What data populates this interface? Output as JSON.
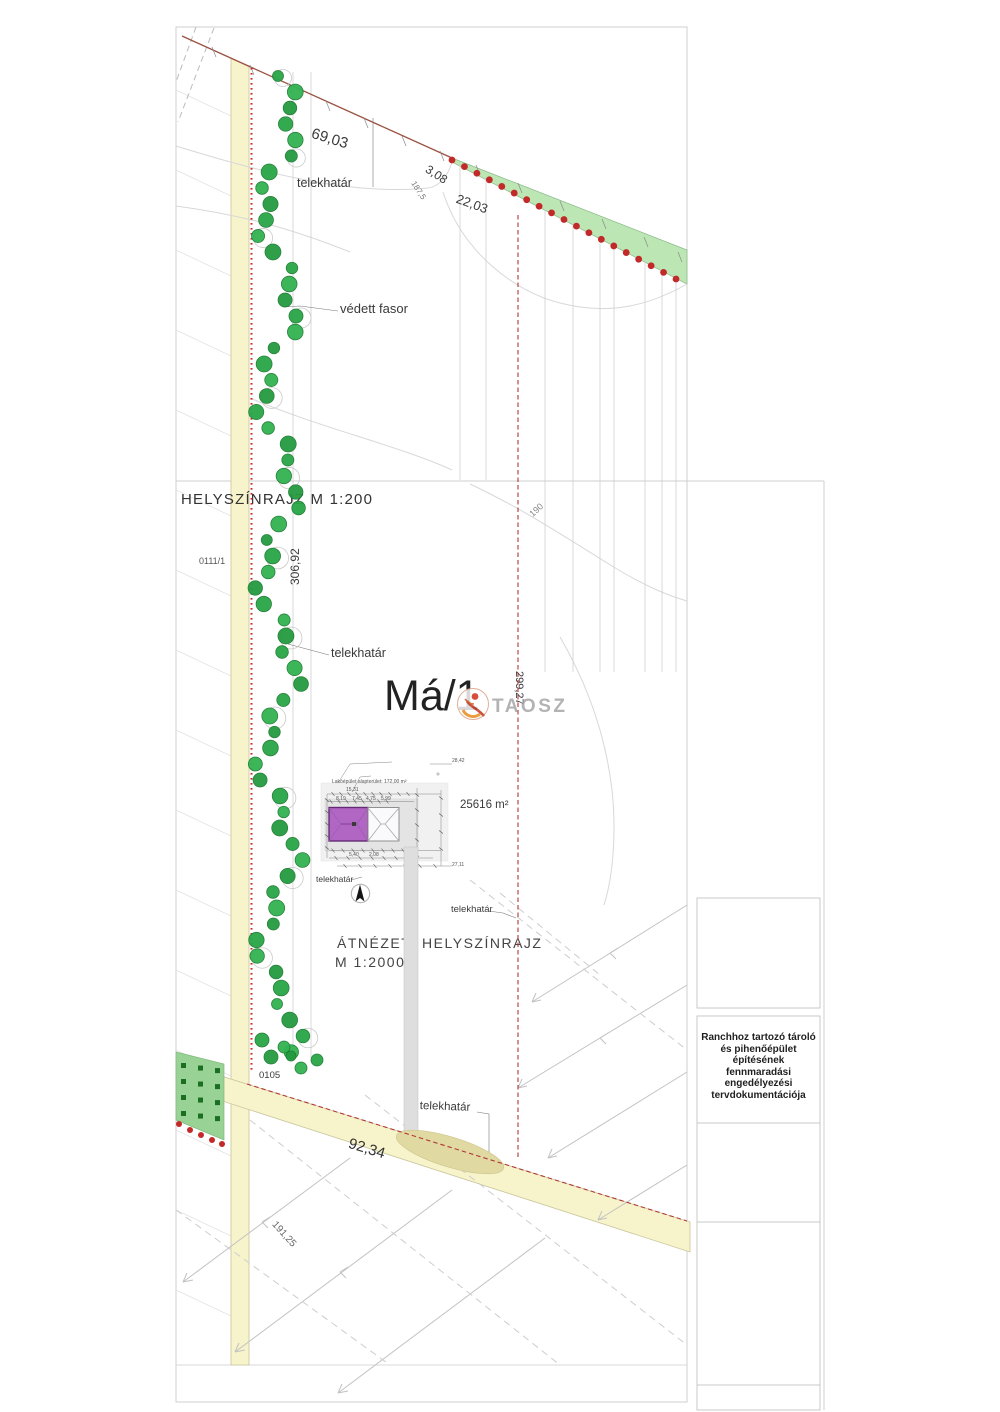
{
  "document": {
    "watermark_text": "TAOSZ"
  },
  "plan_200": {
    "title": "HELYSZÍNRAJZ M 1:200",
    "zone_label": "Má/1",
    "parcel_area": "25616 m²",
    "neighbor_parcel": "0111/1",
    "boundary_label": "telekhatár",
    "protected_trees_label": "védett fasor",
    "contour_label": "190",
    "dims": {
      "north_boundary": "69,03",
      "northeast_1": "3,08",
      "northeast_2": "22,03",
      "northeast_small": "187,5",
      "west_boundary": "306,92",
      "east_boundary": "299,27"
    },
    "building": {
      "note": "Lakóépület alapterület: 172,00 m²",
      "micro_dims": [
        "15,31",
        "8,19",
        "7,45",
        "4,75",
        "5,99",
        "5,40",
        "2,08",
        "28,42",
        "27,11"
      ]
    }
  },
  "plan_2000": {
    "title_line1": "ÁTNÉZETI HELYSZÍNRAJZ",
    "title_line2": "M 1:2000",
    "road_parcel": "0105",
    "boundary_label": "telekhatár",
    "dims": {
      "south_road": "92,34",
      "west_road": "191,25"
    }
  },
  "title_block": {
    "lines": [
      "Ranchhoz tartozó tároló",
      "és pihenőépület",
      "építésének",
      "fennmaradási",
      "engedélyezési",
      "tervdokumentációja"
    ]
  },
  "colors": {
    "road_fill": "#f7f4cc",
    "road_edge": "#c9c49a",
    "tree_green": "#2aa647",
    "tree_stroke": "#1d7c33",
    "wedge_green": "#bce6b4",
    "orchard_green": "#98d295",
    "orchard_square": "#1b6f22",
    "boundary_red": "#c22a2a",
    "building_purple": "#b266c4"
  }
}
